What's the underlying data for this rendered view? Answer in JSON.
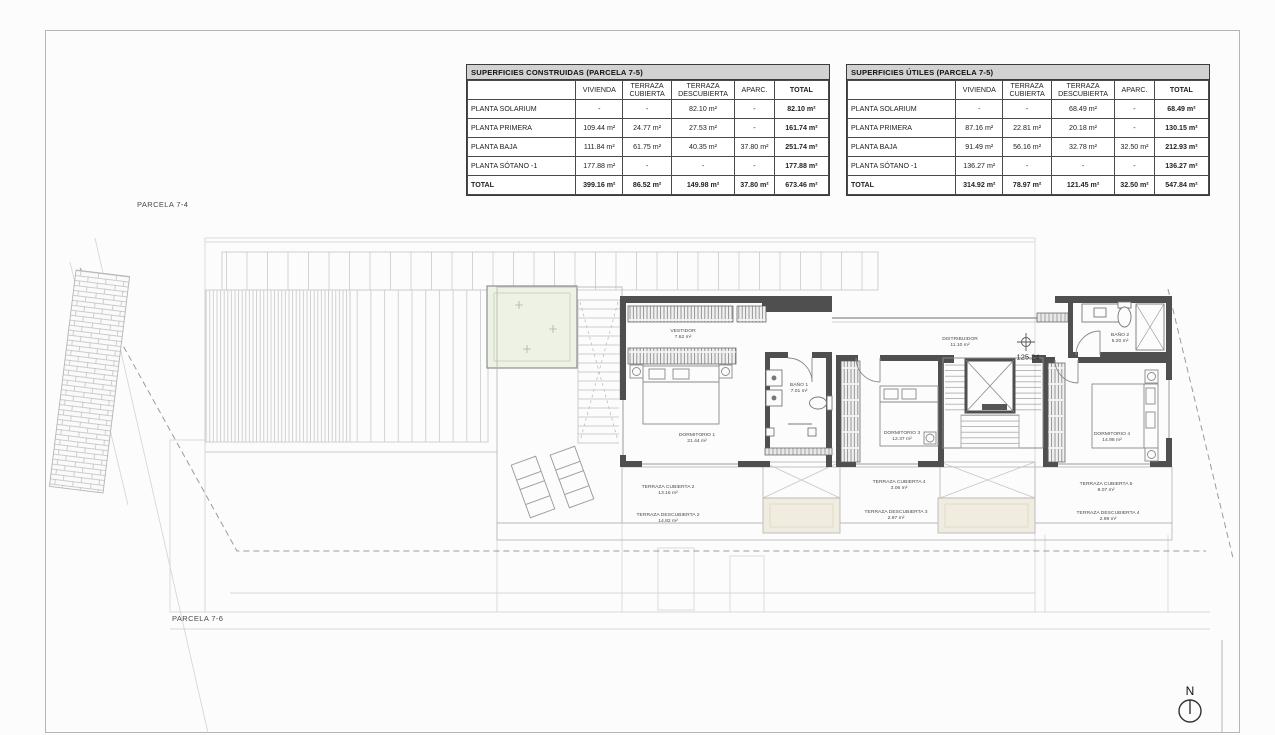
{
  "tables": [
    {
      "title": "SUPERFICIES CONSTRUIDAS (PARCELA 7-5)",
      "columns": [
        "",
        "VIVIENDA",
        "TERRAZA CUBIERTA",
        "TERRAZA DESCUBIERTA",
        "APARC.",
        "TOTAL"
      ],
      "rows": [
        [
          "PLANTA SOLARIUM",
          "-",
          "-",
          "82.10 m²",
          "-",
          "82.10 m²"
        ],
        [
          "PLANTA PRIMERA",
          "109.44 m²",
          "24.77 m²",
          "27.53 m²",
          "-",
          "161.74 m²"
        ],
        [
          "PLANTA BAJA",
          "111.84 m²",
          "61.75 m²",
          "40.35 m²",
          "37.80 m²",
          "251.74 m²"
        ],
        [
          "PLANTA SÓTANO -1",
          "177.88 m²",
          "-",
          "-",
          "-",
          "177.88 m²"
        ]
      ],
      "total_row": [
        "TOTAL",
        "399.16 m²",
        "86.52 m²",
        "149.98 m²",
        "37.80 m²",
        "673.46 m²"
      ]
    },
    {
      "title": "SUPERFICIES ÚTILES (PARCELA 7-5)",
      "columns": [
        "",
        "VIVIENDA",
        "TERRAZA CUBIERTA",
        "TERRAZA DESCUBIERTA",
        "APARC.",
        "TOTAL"
      ],
      "rows": [
        [
          "PLANTA SOLARIUM",
          "-",
          "-",
          "68.49 m²",
          "-",
          "68.49 m²"
        ],
        [
          "PLANTA PRIMERA",
          "87.16 m²",
          "22.81 m²",
          "20.18 m²",
          "-",
          "130.15 m²"
        ],
        [
          "PLANTA BAJA",
          "91.49 m²",
          "56.16 m²",
          "32.78 m²",
          "32.50 m²",
          "212.93 m²"
        ],
        [
          "PLANTA SÓTANO -1",
          "136.27 m²",
          "-",
          "-",
          "-",
          "136.27 m²"
        ]
      ],
      "total_row": [
        "TOTAL",
        "314.92 m²",
        "78.97 m²",
        "121.45 m²",
        "32.50 m²",
        "547.84 m²"
      ]
    }
  ],
  "plan": {
    "parcela_top": "PARCELA 7-4",
    "parcela_bottom": "PARCELA 7-6",
    "level_mark": "125.24",
    "north_label": "N",
    "rooms": [
      {
        "id": "vestidor",
        "name": "VESTIDOR",
        "area": "7.62 m²"
      },
      {
        "id": "dormitorio-1",
        "name": "DORMITORIO 1",
        "area": "21.44 m²"
      },
      {
        "id": "bano-1",
        "name": "BAÑO 1",
        "area": "7.01 m²"
      },
      {
        "id": "distribuidor",
        "name": "DISTRIBUIDOR",
        "area": "11.10 m²"
      },
      {
        "id": "dormitorio-3",
        "name": "DORMITORIO 3",
        "area": "12.37 m²"
      },
      {
        "id": "bano-2",
        "name": "BAÑO 2",
        "area": "5.20 m²"
      },
      {
        "id": "dormitorio-4",
        "name": "DORMITORIO 4",
        "area": "14.98 m²"
      },
      {
        "id": "terraza-cubierta-2",
        "name": "TERRAZA CUBIERTA 2",
        "area": "13.16 m²"
      },
      {
        "id": "terraza-descubierta-2",
        "name": "TERRAZA DESCUBIERTA 2",
        "area": "14.82 m²"
      },
      {
        "id": "terraza-cubierta-4",
        "name": "TERRAZA CUBIERTA 4",
        "area": "3.06 m²"
      },
      {
        "id": "terraza-descubierta-3",
        "name": "TERRAZA DESCUBIERTA 3",
        "area": "2.97 m²"
      },
      {
        "id": "terraza-cubierta-5",
        "name": "TERRAZA CUBIERTA 5",
        "area": "8.07 m²"
      },
      {
        "id": "terraza-descubierta-4",
        "name": "TERRAZA DESCUBIERTA 4",
        "area": "2.99 m²"
      }
    ]
  },
  "colors": {
    "wall": "#4f4f4f",
    "faint_line": "#d7d7d7",
    "line": "#b9b9b9",
    "green_skylight": "#eef2e5",
    "beige_skylight": "#f0ecdf",
    "table_header_bg": "#d2d2d2"
  }
}
